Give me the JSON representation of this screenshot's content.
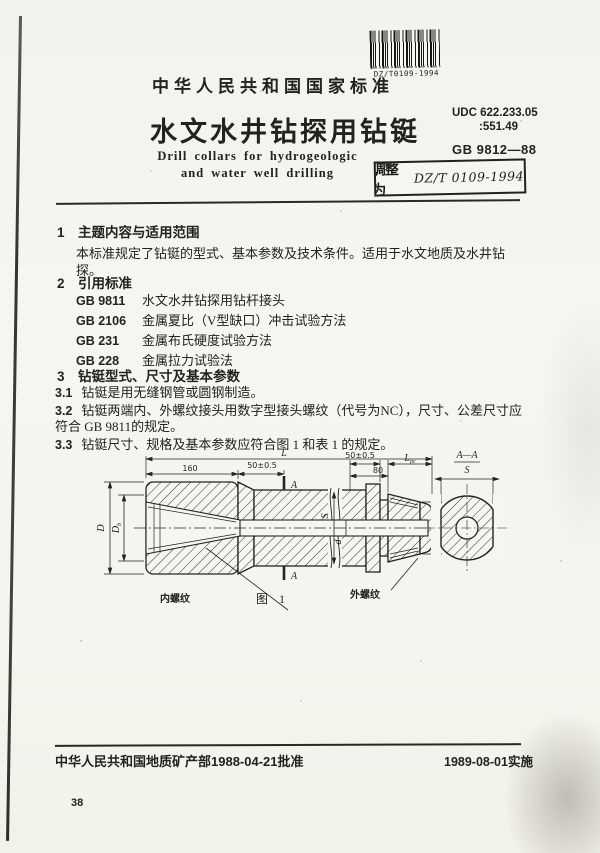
{
  "document": {
    "header": {
      "national_standard_label": "中华人民共和国国家标准",
      "title_cn": "水文水井钻探用钻铤",
      "title_en_line1": "Drill collars for hydrogeologic",
      "title_en_line2": "and water well drilling",
      "udc_line1": "UDC 622.233.05",
      "udc_line2": ":551.49",
      "standard_code": "GB 9812—88",
      "barcode_label": "DZ/T0109-1994",
      "stamp_prefix": "调整为",
      "stamp_number": "DZ/T 0109-1994"
    },
    "sections": {
      "s1": {
        "heading": "1　主题内容与适用范围",
        "body": "本标准规定了钻铤的型式、基本参数及技术条件。适用于水文地质及水井钻探。"
      },
      "s2": {
        "heading": "2　引用标准",
        "refs": [
          {
            "code": "GB 9811",
            "title": "水文水井钻探用钻杆接头"
          },
          {
            "code": "GB 2106",
            "title": "金属夏比（V型缺口）冲击试验方法"
          },
          {
            "code": "GB 231",
            "title": "金属布氏硬度试验方法"
          },
          {
            "code": "GB 228",
            "title": "金属拉力试验法"
          }
        ]
      },
      "s3": {
        "heading": "3　钻铤型式、尺寸及基本参数",
        "clauses": [
          {
            "num": "3.1",
            "text": "钻铤是用无缝钢管或圆钢制造。"
          },
          {
            "num": "3.2",
            "text": "钻铤两端内、外螺纹接头用数字型接头螺纹（代号为NC），尺寸、公差尺寸应符合 GB 9811的规定。"
          },
          {
            "num": "3.3",
            "text": "钻铤尺寸、规格及基本参数应符合图 1 和表 1 的规定。"
          }
        ]
      }
    },
    "figure": {
      "caption": "图 1",
      "internal_thread_label": "内螺纹",
      "external_thread_label": "外螺纹",
      "section_view_title": "A—A",
      "dims": {
        "L": "L",
        "len160": "160",
        "tol50": "50±0.5",
        "len80": "80",
        "sub_pc": "pc",
        "D": "D",
        "sub_b": "b",
        "sub_p": "p",
        "S": "S",
        "d": "d",
        "A": "A"
      }
    },
    "footer": {
      "approval": "中华人民共和国地质矿产部1988-04-21批准",
      "implementation": "1989-08-01实施",
      "page_number": "38"
    }
  }
}
